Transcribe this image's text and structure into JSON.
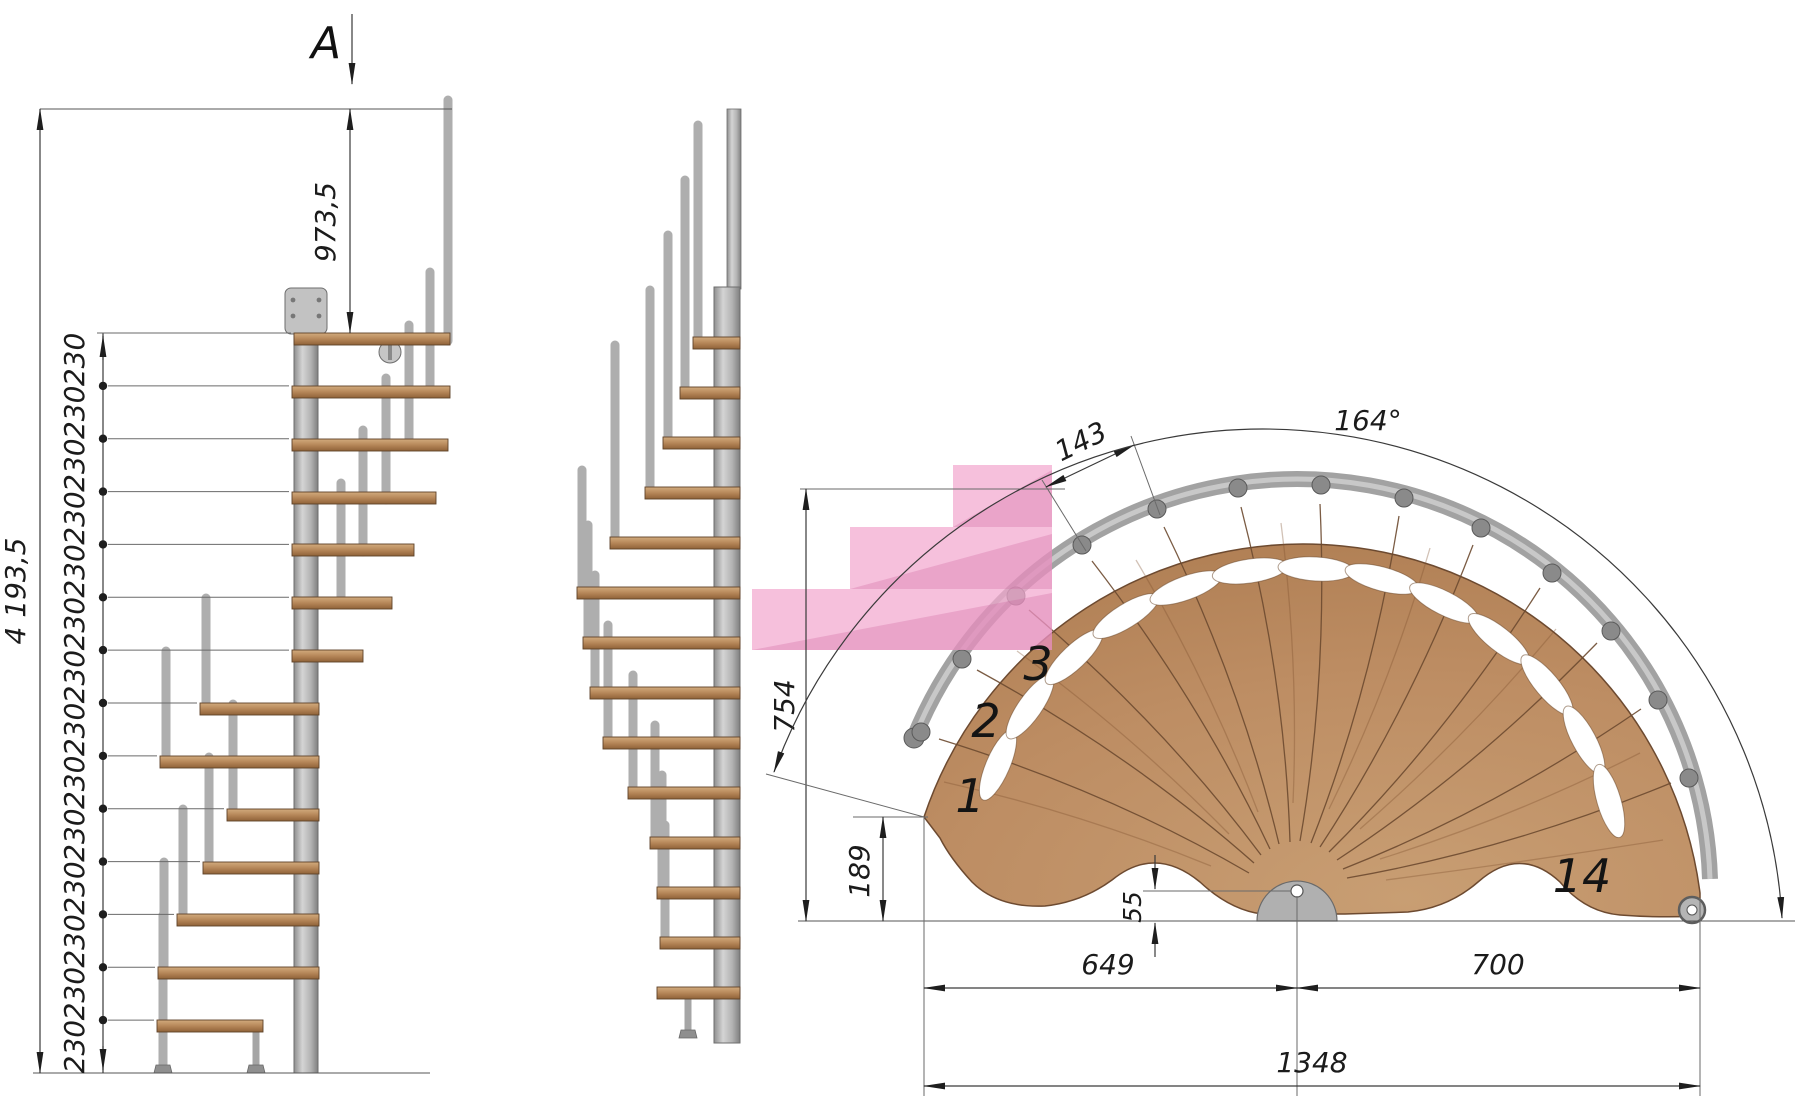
{
  "drawing": {
    "section_marker": {
      "label": "A"
    },
    "elevation": {
      "total_height": "4 193,5",
      "top_height": "973,5",
      "riser": "230",
      "riser_count": 14
    },
    "plan": {
      "tread_width": "143",
      "fan_angle": "164°",
      "depth": "754",
      "corner_offset": "189",
      "center_offset": "55",
      "span_left": "649",
      "span_right": "700",
      "span_total": "1348",
      "step_1": "1",
      "step_2": "2",
      "step_3": "3",
      "step_14": "14"
    },
    "colors": {
      "wood": "#bf8f66",
      "steel": "#aeaeae",
      "highlight_pink": "#f2a7cf",
      "line": "#3a3a3a"
    }
  }
}
